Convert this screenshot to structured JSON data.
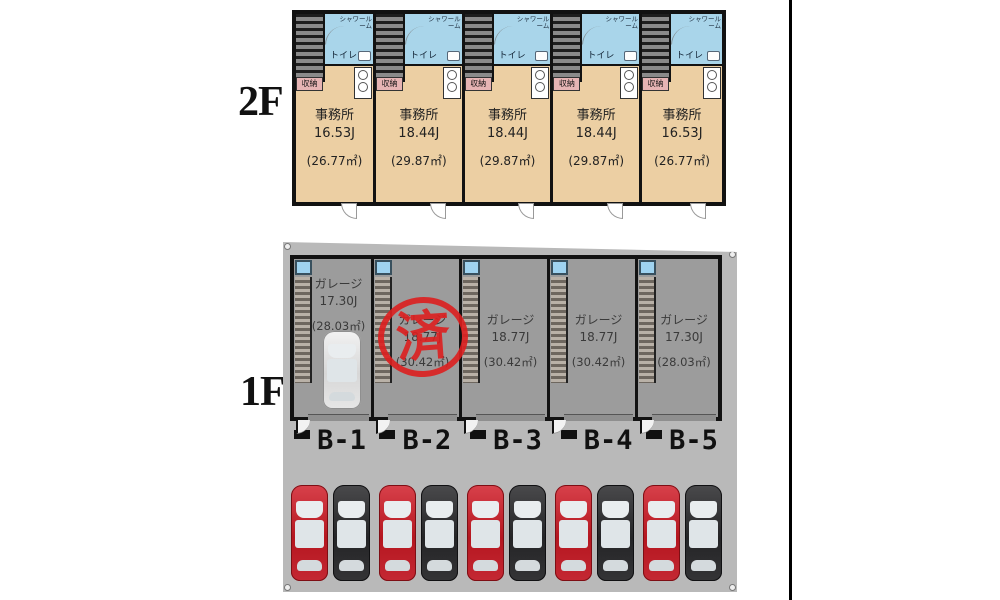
{
  "floor2": {
    "label": "2F",
    "units": [
      {
        "type": "事務所",
        "size_j": "16.53J",
        "size_m2": "(26.77㎡)",
        "shower": "シャワールーム",
        "toilet": "トイレ",
        "storage": "収納"
      },
      {
        "type": "事務所",
        "size_j": "18.44J",
        "size_m2": "(29.87㎡)",
        "shower": "シャワールーム",
        "toilet": "トイレ",
        "storage": "収納"
      },
      {
        "type": "事務所",
        "size_j": "18.44J",
        "size_m2": "(29.87㎡)",
        "shower": "シャワールーム",
        "toilet": "トイレ",
        "storage": "収納"
      },
      {
        "type": "事務所",
        "size_j": "18.44J",
        "size_m2": "(29.87㎡)",
        "shower": "シャワールーム",
        "toilet": "トイレ",
        "storage": "収納"
      },
      {
        "type": "事務所",
        "size_j": "16.53J",
        "size_m2": "(26.77㎡)",
        "shower": "シャワールーム",
        "toilet": "トイレ",
        "storage": "収納"
      }
    ]
  },
  "floor1": {
    "label": "1F",
    "units": [
      {
        "id": "B-1",
        "type": "ガレージ",
        "size_j": "17.30J",
        "size_m2": "(28.03㎡)"
      },
      {
        "id": "B-2",
        "type": "ガレージ",
        "size_j": "18.77J",
        "size_m2": "(30.42㎡)",
        "stamp": "済"
      },
      {
        "id": "B-3",
        "type": "ガレージ",
        "size_j": "18.77J",
        "size_m2": "(30.42㎡)"
      },
      {
        "id": "B-4",
        "type": "ガレージ",
        "size_j": "18.77J",
        "size_m2": "(30.42㎡)"
      },
      {
        "id": "B-5",
        "type": "ガレージ",
        "size_j": "17.30J",
        "size_m2": "(28.03㎡)"
      }
    ],
    "parking_cars": [
      "red",
      "black",
      "red",
      "black",
      "red",
      "black",
      "red",
      "black",
      "red",
      "black"
    ]
  },
  "colors": {
    "room_beige": "#eccfa3",
    "wet_blue": "#a9d5ea",
    "garage_gray": "#9c9c9c",
    "lot_gray": "#b9b9b9",
    "stamp_red": "#dd1f1f",
    "car_red": "#c42833",
    "car_black": "#2c2c2e"
  }
}
